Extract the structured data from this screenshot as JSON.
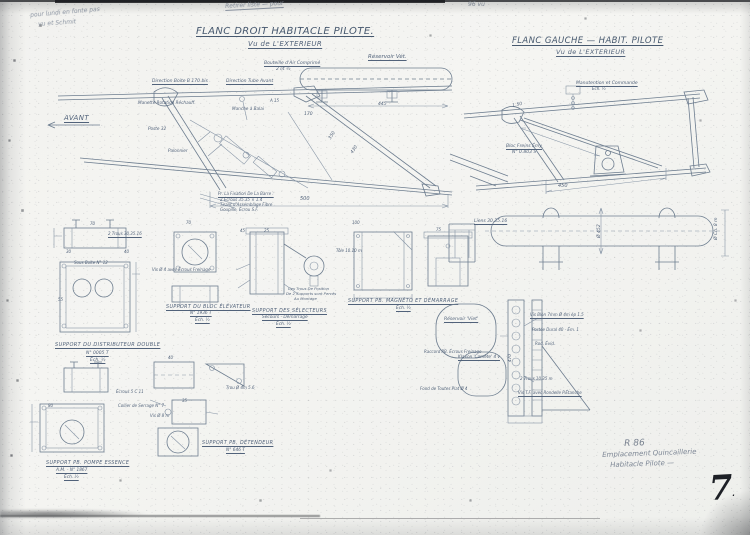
{
  "page": {
    "number": "7",
    "number_dot": ".",
    "corner_note": {
      "ref": "R 86",
      "line1": "Emplacement Quincaillerie",
      "line2": "Habitacle Pilote —"
    },
    "pencil": {
      "tl1": "pour lundi en fonte pas",
      "tl2": "vu et Schmit",
      "top": "Retirer liste — pour",
      "mark": "96  vu"
    }
  },
  "titles": {
    "left1": "FLANC DROIT  HABITACLE  PILOTE.",
    "left2": "Vu de L'EXTERIEUR",
    "right1": "FLANC GAUCHE  —  HABIT. PILOTE",
    "right2": "Vu de L'EXTERIEUR"
  },
  "left_view": {
    "avant": "AVANT",
    "reservoir": "Réservoir Vét.",
    "bouteille1": "Bouteille d'Air Comprimé",
    "bouteille2": "2 lit ½",
    "direction_boite": "Direction Boite  B 170 bis",
    "direction_tube": "Direction Tube Avant",
    "manette": "Manette Rotation Réchauff.",
    "manche": "Manche à Balai",
    "poste": "Poste 32",
    "palonnier": "Palonnier",
    "fix1": "Pr. La Fixation De La Barre :",
    "fix2": "2 Écrous  35.35 × 1.4",
    "fix3": "Tirant d'Assemblage Fibre",
    "fix4": "Goupille, Écrou  S.F.",
    "d500": "500",
    "d445": "445",
    "d170": "170",
    "d350": "350",
    "d430": "430",
    "a15": "A 15"
  },
  "right_view": {
    "manut1": "Manutention et Commande",
    "manut2": "Éch. ½",
    "d150": "1.50",
    "bloc1": "Bloc Freins Émy",
    "bloc2": "N° 0.803 S",
    "d450": "450"
  },
  "cylinder": {
    "liens": "Liens 30.35.16",
    "dia": "Ø 452",
    "dia2": "Ø Ch. 8 m"
  },
  "captions": {
    "distributeur": [
      "SUPPORT DU DISTRIBUTEUR DOUBLE",
      "N° 0005 T",
      "Éch. ½"
    ],
    "elevateur": [
      "SUPPORT DU BLOC ÉLÉVATEUR",
      "N° 1936 T",
      "Éch. ½"
    ],
    "selecteurs": [
      "SUPPORT DES SÉLECTEURS",
      "Secours - Démarrage",
      "Éch. ½"
    ],
    "magneto": [
      "SUPPORT PB. MAGNÉTO ET DÉMARRAGE",
      "Éch. ½"
    ],
    "pompe": [
      "SUPPORT PB. POMPE ESSENCE",
      "A.M. - N° 1867",
      "Éch. ½"
    ],
    "detendeur": [
      "SUPPORT PB. DÉTENDEUR",
      "N° 646 T"
    ]
  },
  "details": {
    "reservoir_viet": "Réservoir 'Viet'",
    "klaxon": "Klaxon 'Comète' 4 v",
    "vis_blon": "Vis Blon 7mm Ø 4m ép 1.5",
    "portee": "Portée Dural 40 - Ém. 1",
    "rad": "Rod. Évid.",
    "trous10": "2 Trous 10.35 m",
    "vis_tf": "Vis T.F. avec Rondelle P.Étanche",
    "raccord": "Raccord PB. Écrous Freinage",
    "fond": "Fond de Toutes  Plat Ø 4",
    "trous30": "2 Trous 30.35.16",
    "sous_boite": "Sous Boîte N° 12",
    "vis_ecrous": "Vis Ø 4 avec Écrous Freinage",
    "ecrous": "Écrous 5 C 11",
    "collier": "Collier de Serrage N° 7",
    "trou_d4": "Trou Ø 4m 5.6",
    "vis_d8": "Vis Ø 8 m",
    "tole": "Tôle 10.10 m",
    "mont1": "Ces Trous De Position",
    "mont2": "De 2 Supports sont Percés",
    "mont3": "Au Montage",
    "d470": "470"
  },
  "dims": [
    "70",
    "30",
    "40",
    "70",
    "45",
    "25",
    "100",
    "75",
    "55",
    "40",
    "80",
    "35"
  ]
}
